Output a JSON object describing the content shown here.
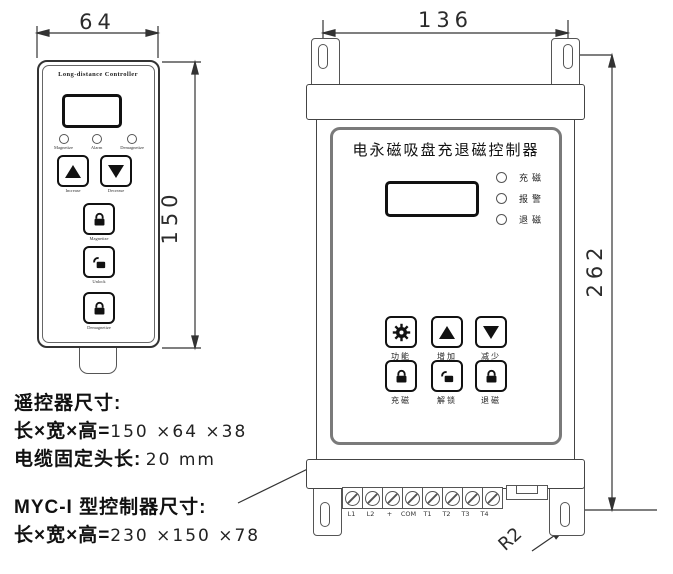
{
  "remote": {
    "title": "Long-distance Controller",
    "width_dim": "64",
    "height_dim": "150",
    "indicators": [
      {
        "label": "Magnetize"
      },
      {
        "label": "Alarm"
      },
      {
        "label": "Demagnetize"
      }
    ],
    "buttons": [
      {
        "label": "Increase",
        "icon": "up-arrow-icon"
      },
      {
        "label": "Decrease",
        "icon": "down-arrow-icon"
      },
      {
        "label": "Magnetize",
        "icon": "lock-icon"
      },
      {
        "label": "Unlock",
        "icon": "unlock-icon"
      },
      {
        "label": "Demagnetize",
        "icon": "lock-icon"
      }
    ]
  },
  "controller": {
    "title": "电永磁吸盘充退磁控制器",
    "width_dim": "136",
    "height_dim": "262",
    "corner_radius": "R2",
    "indicators": [
      {
        "label": "充磁"
      },
      {
        "label": "报警"
      },
      {
        "label": "退磁"
      }
    ],
    "buttons": [
      {
        "label": "功能",
        "icon": "gear-icon"
      },
      {
        "label": "增加",
        "icon": "up-arrow-icon"
      },
      {
        "label": "减少",
        "icon": "down-arrow-icon"
      },
      {
        "label": "充磁",
        "icon": "lock-icon"
      },
      {
        "label": "解锁",
        "icon": "unlock-icon"
      },
      {
        "label": "退磁",
        "icon": "lock-icon"
      }
    ],
    "terminals": [
      {
        "label": "L1"
      },
      {
        "label": "L2"
      },
      {
        "label": "+"
      },
      {
        "label": "COM"
      },
      {
        "label": "T1"
      },
      {
        "label": "T2"
      },
      {
        "label": "T3"
      },
      {
        "label": "T4"
      }
    ]
  },
  "notes": {
    "remote_heading": "遥控器尺寸:",
    "remote_dims_prefix": "长×宽×高=",
    "remote_dims_value": "150 ×64 ×38",
    "cable_prefix": "电缆固定头长:",
    "cable_value": "20 mm",
    "controller_heading": "MYC-I 型控制器尺寸:",
    "controller_dims_prefix": "长×宽×高=",
    "controller_dims_value": "230 ×150 ×78"
  }
}
